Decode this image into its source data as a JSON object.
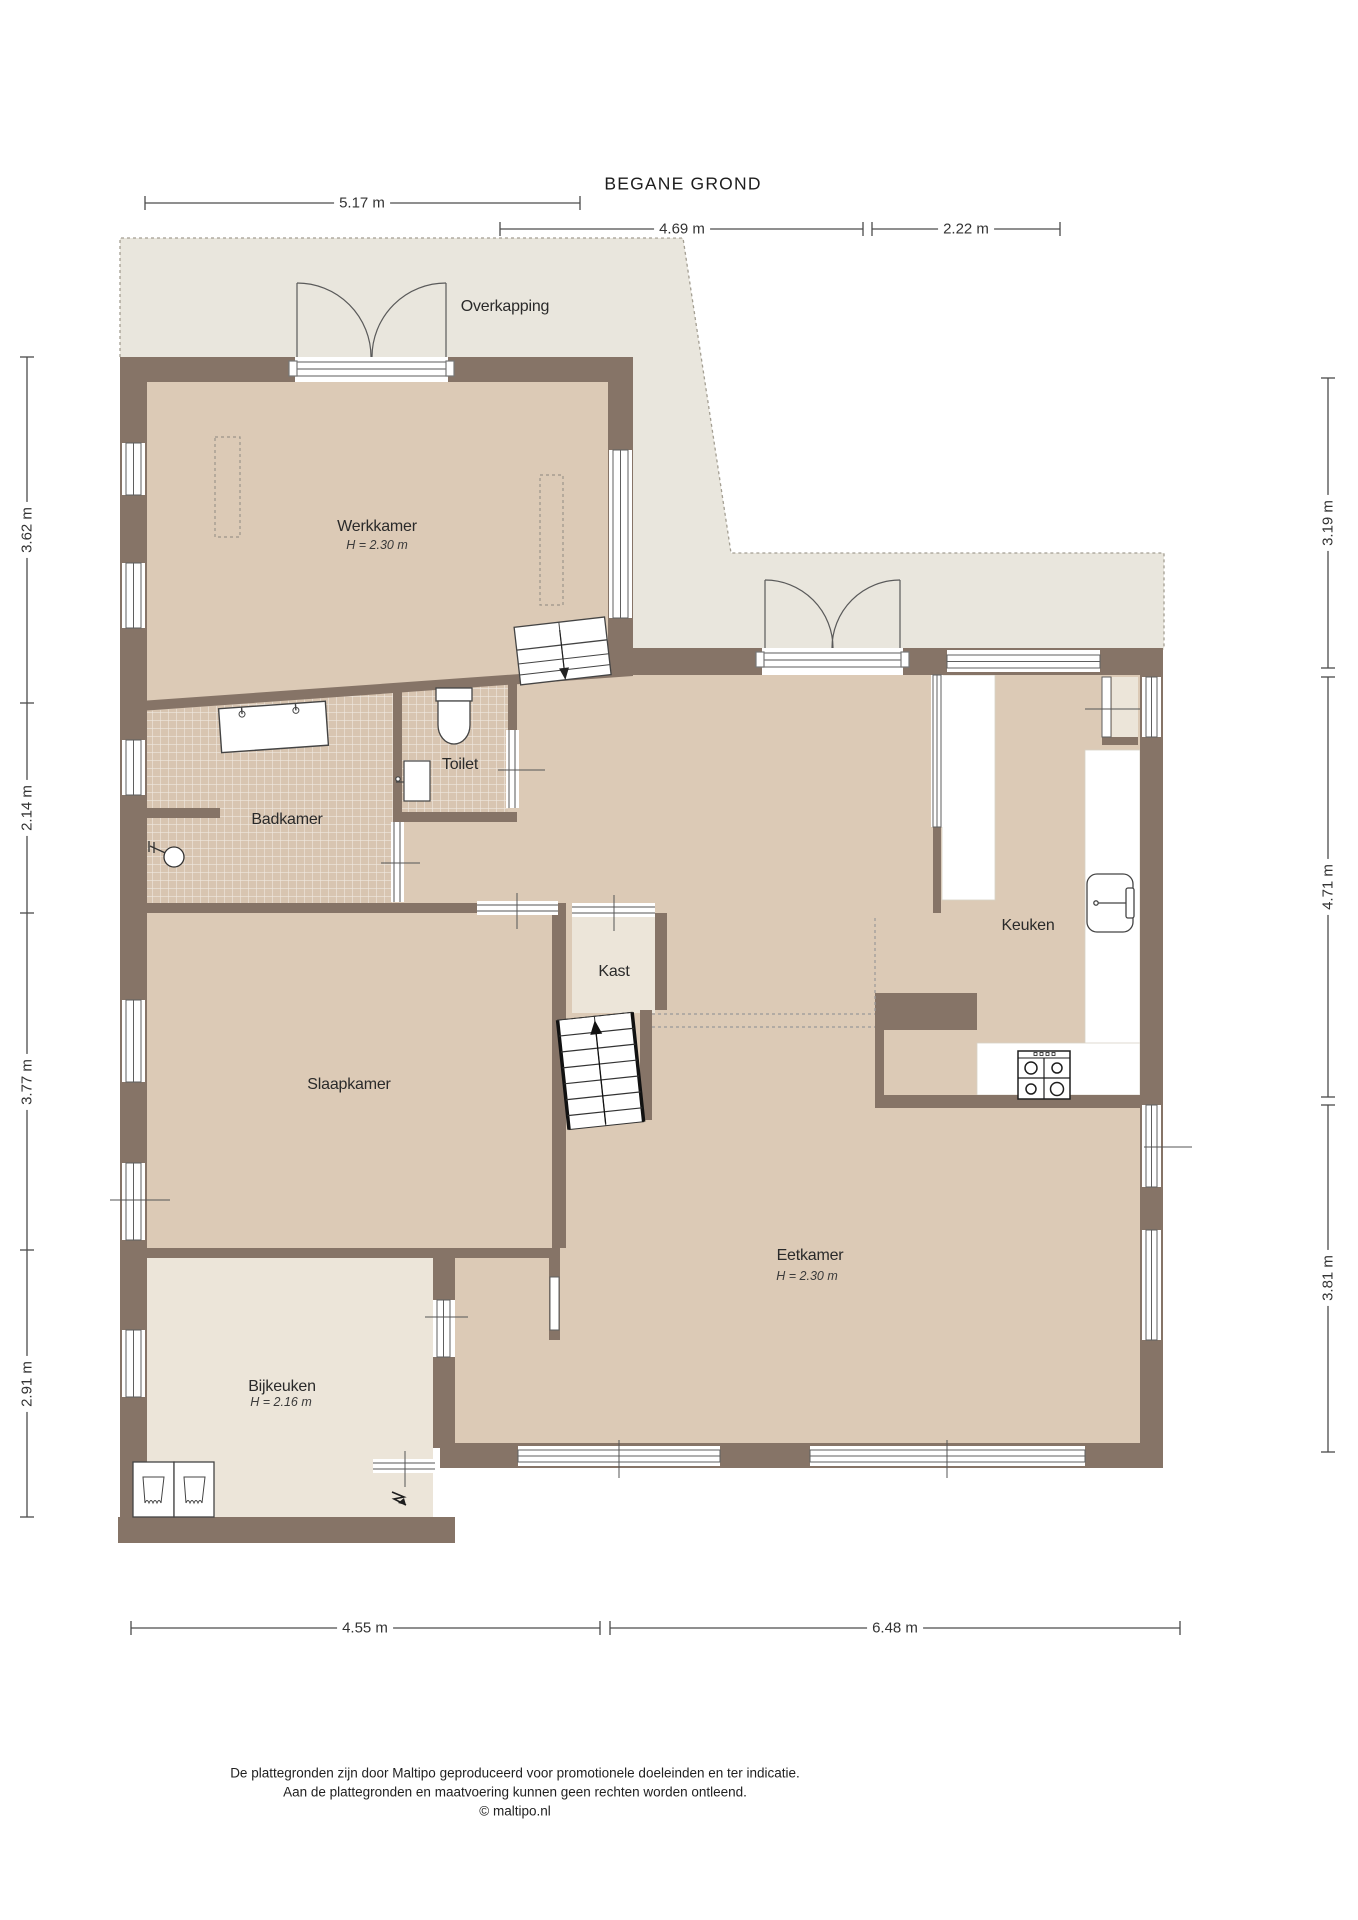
{
  "title": "BEGANE GROND",
  "rooms": {
    "overkapping": {
      "label": "Overkapping"
    },
    "werkkamer": {
      "label": "Werkkamer",
      "height": "H = 2.30 m"
    },
    "badkamer": {
      "label": "Badkamer"
    },
    "toilet": {
      "label": "Toilet"
    },
    "kast": {
      "label": "Kast"
    },
    "slaapkamer": {
      "label": "Slaapkamer"
    },
    "keuken": {
      "label": "Keuken"
    },
    "eetkamer": {
      "label": "Eetkamer",
      "height": "H = 2.30 m"
    },
    "bijkeuken": {
      "label": "Bijkeuken",
      "height": "H = 2.16 m"
    }
  },
  "dimensions": {
    "top": [
      {
        "value": "5.17 m"
      },
      {
        "value": "4.69 m"
      },
      {
        "value": "2.22 m"
      }
    ],
    "left": [
      {
        "value": "3.62 m"
      },
      {
        "value": "2.14 m"
      },
      {
        "value": "3.77 m"
      },
      {
        "value": "2.91 m"
      }
    ],
    "right": [
      {
        "value": "3.19 m"
      },
      {
        "value": "4.71 m"
      },
      {
        "value": "3.81 m"
      }
    ],
    "bottom": [
      {
        "value": "4.55 m"
      },
      {
        "value": "6.48 m"
      }
    ]
  },
  "footer": {
    "line1": "De plattegronden zijn door Maltipo geproduceerd voor promotionele doeleinden en ter indicatie.",
    "line2": "Aan de plattegronden en maatvoering kunnen geen rechten worden ontleend.",
    "line3": "© maltipo.nl"
  },
  "colors": {
    "wall": "#867467",
    "floor_tan": "#dccab6",
    "floor_light": "#ece5d9",
    "canopy_gray": "#e9e6dd",
    "tile": "#d8c5b1"
  }
}
